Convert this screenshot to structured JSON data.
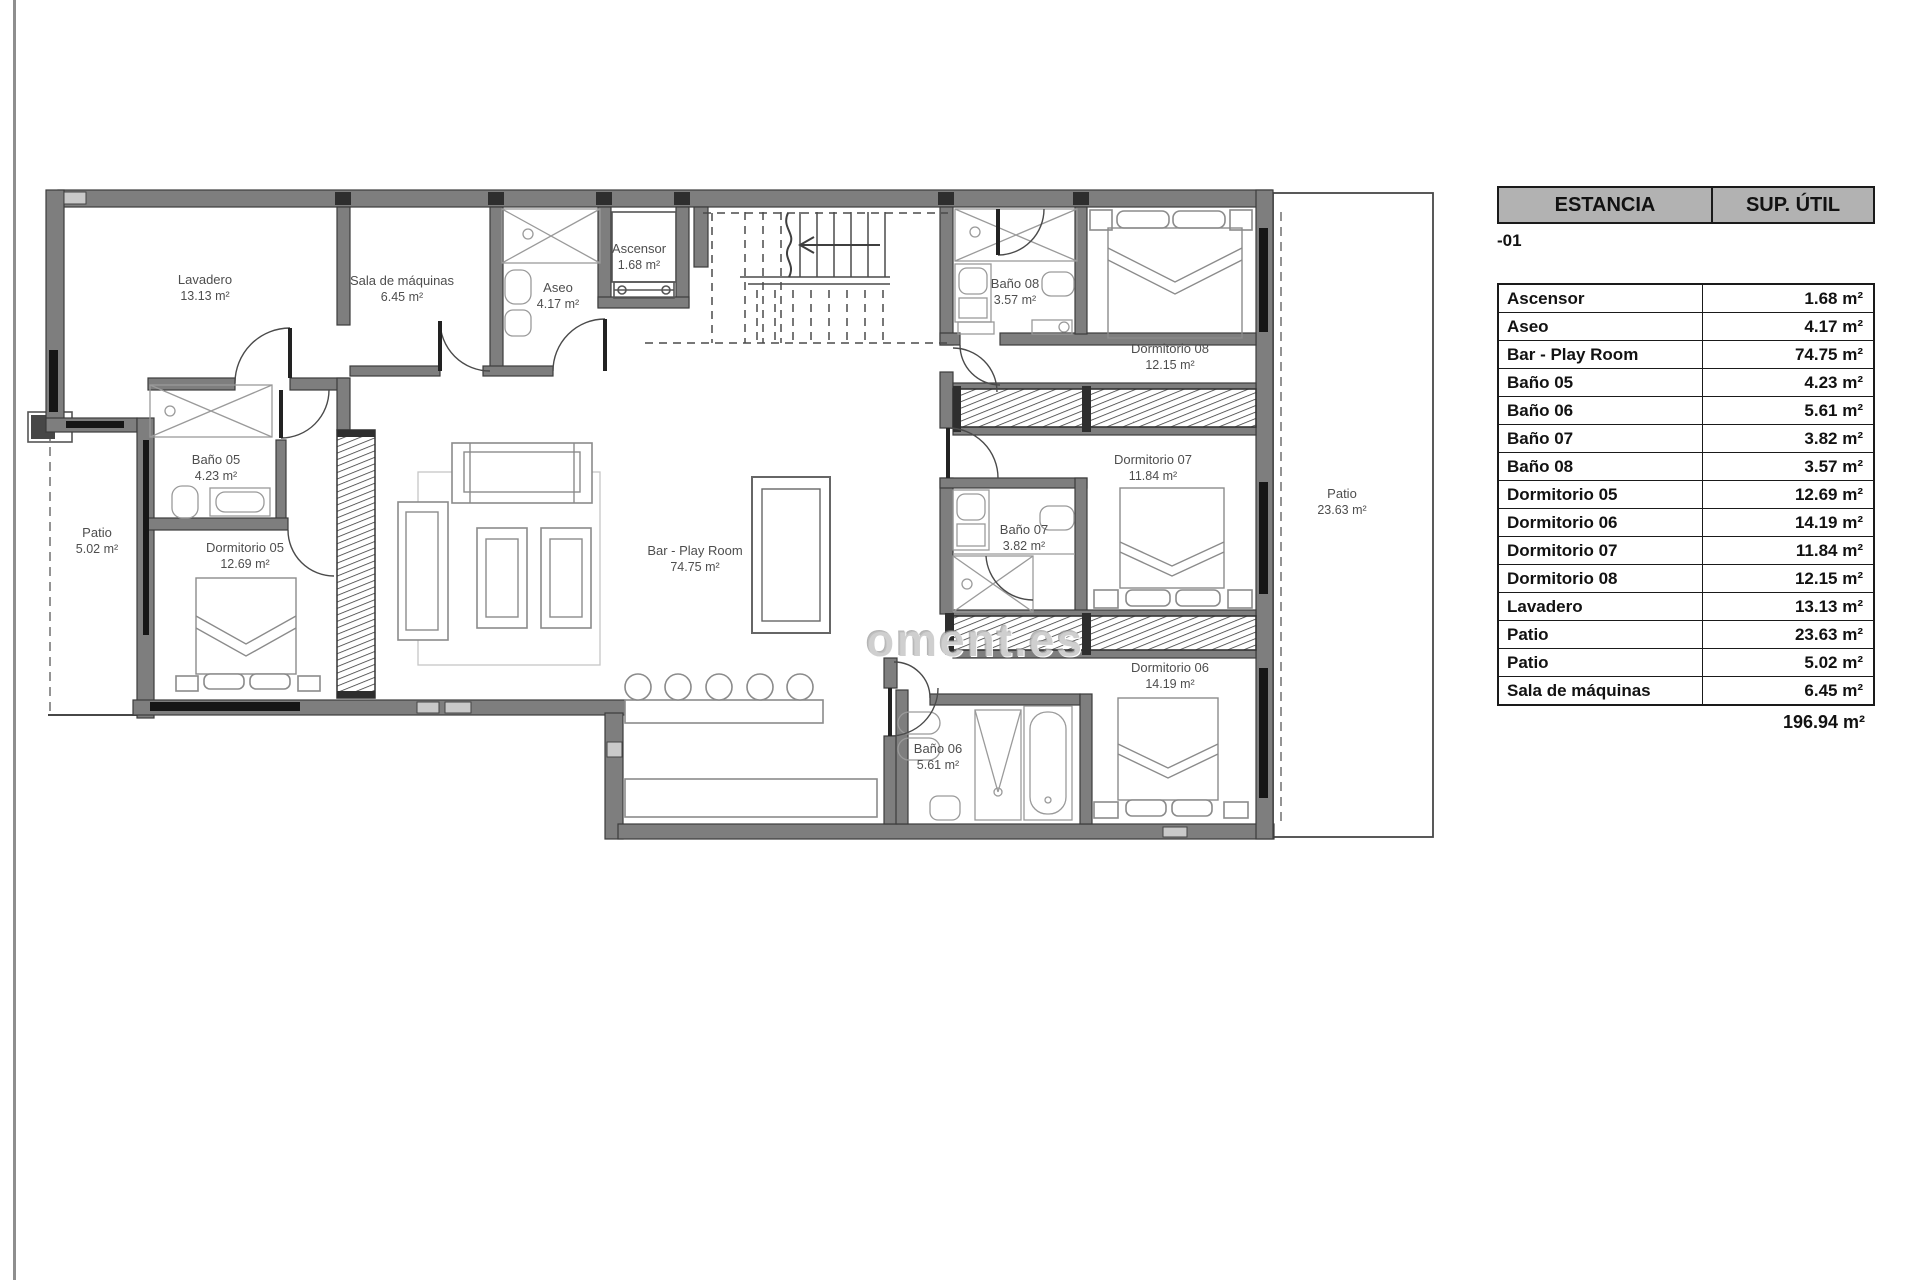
{
  "page": {
    "background": "#ffffff"
  },
  "plan": {
    "watermark": "oment.es",
    "labels": [
      {
        "id": "lavadero",
        "name": "Lavadero",
        "area": "13.13 m²",
        "x": 205,
        "y": 288
      },
      {
        "id": "sala-de-maquinas",
        "name": "Sala de máquinas",
        "area": "6.45 m²",
        "x": 402,
        "y": 289
      },
      {
        "id": "aseo",
        "name": "Aseo",
        "area": "4.17 m²",
        "x": 558,
        "y": 296
      },
      {
        "id": "ascensor",
        "name": "Ascensor",
        "area": "1.68 m²",
        "x": 639,
        "y": 257
      },
      {
        "id": "bano-08",
        "name": "Baño 08",
        "area": "3.57 m²",
        "x": 1015,
        "y": 292
      },
      {
        "id": "dormitorio-08",
        "name": "Dormitorio 08",
        "area": "12.15 m²",
        "x": 1170,
        "y": 357
      },
      {
        "id": "dormitorio-07",
        "name": "Dormitorio 07",
        "area": "11.84 m²",
        "x": 1153,
        "y": 468
      },
      {
        "id": "bano-07",
        "name": "Baño 07",
        "area": "3.82 m²",
        "x": 1024,
        "y": 538
      },
      {
        "id": "bar-play-room",
        "name": "Bar - Play Room",
        "area": "74.75 m²",
        "x": 695,
        "y": 559
      },
      {
        "id": "patio-grande",
        "name": "Patio",
        "area": "23.63 m²",
        "x": 1342,
        "y": 502
      },
      {
        "id": "patio-pequeno",
        "name": "Patio",
        "area": "5.02 m²",
        "x": 97,
        "y": 541
      },
      {
        "id": "bano-05",
        "name": "Baño 05",
        "area": "4.23 m²",
        "x": 216,
        "y": 468
      },
      {
        "id": "dormitorio-05",
        "name": "Dormitorio 05",
        "area": "12.69 m²",
        "x": 245,
        "y": 556
      },
      {
        "id": "dormitorio-06",
        "name": "Dormitorio 06",
        "area": "14.19 m²",
        "x": 1170,
        "y": 676
      },
      {
        "id": "bano-06",
        "name": "Baño 06",
        "area": "5.61 m²",
        "x": 938,
        "y": 757
      }
    ]
  },
  "table": {
    "header": {
      "col_room": "ESTANCIA",
      "col_area": "SUP. ÚTIL"
    },
    "level_label": "-01",
    "rows": [
      {
        "name": "Ascensor",
        "area": "1.68 m²"
      },
      {
        "name": "Aseo",
        "area": "4.17 m²"
      },
      {
        "name": "Bar - Play Room",
        "area": "74.75 m²"
      },
      {
        "name": "Baño 05",
        "area": "4.23 m²"
      },
      {
        "name": "Baño 06",
        "area": "5.61 m²"
      },
      {
        "name": "Baño 07",
        "area": "3.82 m²"
      },
      {
        "name": "Baño 08",
        "area": "3.57 m²"
      },
      {
        "name": "Dormitorio 05",
        "area": "12.69 m²"
      },
      {
        "name": "Dormitorio 06",
        "area": "14.19 m²"
      },
      {
        "name": "Dormitorio 07",
        "area": "11.84 m²"
      },
      {
        "name": "Dormitorio 08",
        "area": "12.15 m²"
      },
      {
        "name": "Lavadero",
        "area": "13.13 m²"
      },
      {
        "name": "Patio",
        "area": "23.63 m²"
      },
      {
        "name": "Patio",
        "area": "5.02 m²"
      },
      {
        "name": "Sala de máquinas",
        "area": "6.45 m²"
      }
    ],
    "total": "196.94 m²"
  }
}
